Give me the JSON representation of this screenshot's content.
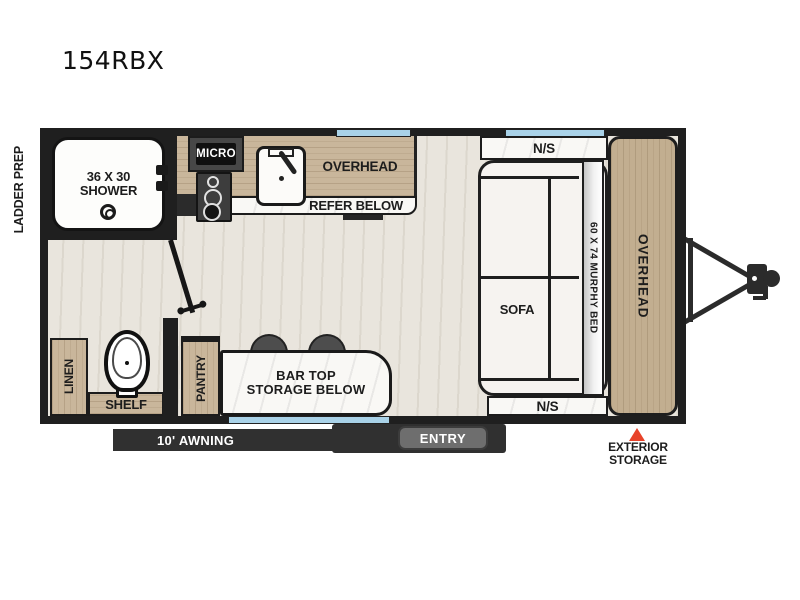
{
  "page": {
    "title": "154RBX"
  },
  "colors": {
    "wall": "#1f1f1f",
    "wood": "#c9b69b",
    "floor": "#e6e2da",
    "marble": "#f9f8f5",
    "window_blue": "#a9d2e8",
    "accent_red": "#e8432a",
    "band_dark": "#303030",
    "entry_gray": "#6e6e6e"
  },
  "exterior": {
    "ladder_prep": "LADDER PREP",
    "awning": "10' AWNING",
    "entry": "ENTRY",
    "storage_line1": "EXTERIOR",
    "storage_line2": "STORAGE"
  },
  "bathroom": {
    "shower_line1": "36 X 30",
    "shower_line2": "SHOWER",
    "linen": "LINEN",
    "shelf": "SHELF"
  },
  "kitchen": {
    "micro": "MICRO",
    "overhead": "OVERHEAD",
    "refer": "REFER BELOW",
    "pantry": "PANTRY",
    "bar_line1": "BAR TOP",
    "bar_line2": "STORAGE BELOW"
  },
  "bedroom": {
    "ns_top": "N/S",
    "ns_bottom": "N/S",
    "sofa": "SOFA",
    "murphy_bed": "60 X 74 MURPHY BED",
    "overhead": "OVERHEAD"
  }
}
